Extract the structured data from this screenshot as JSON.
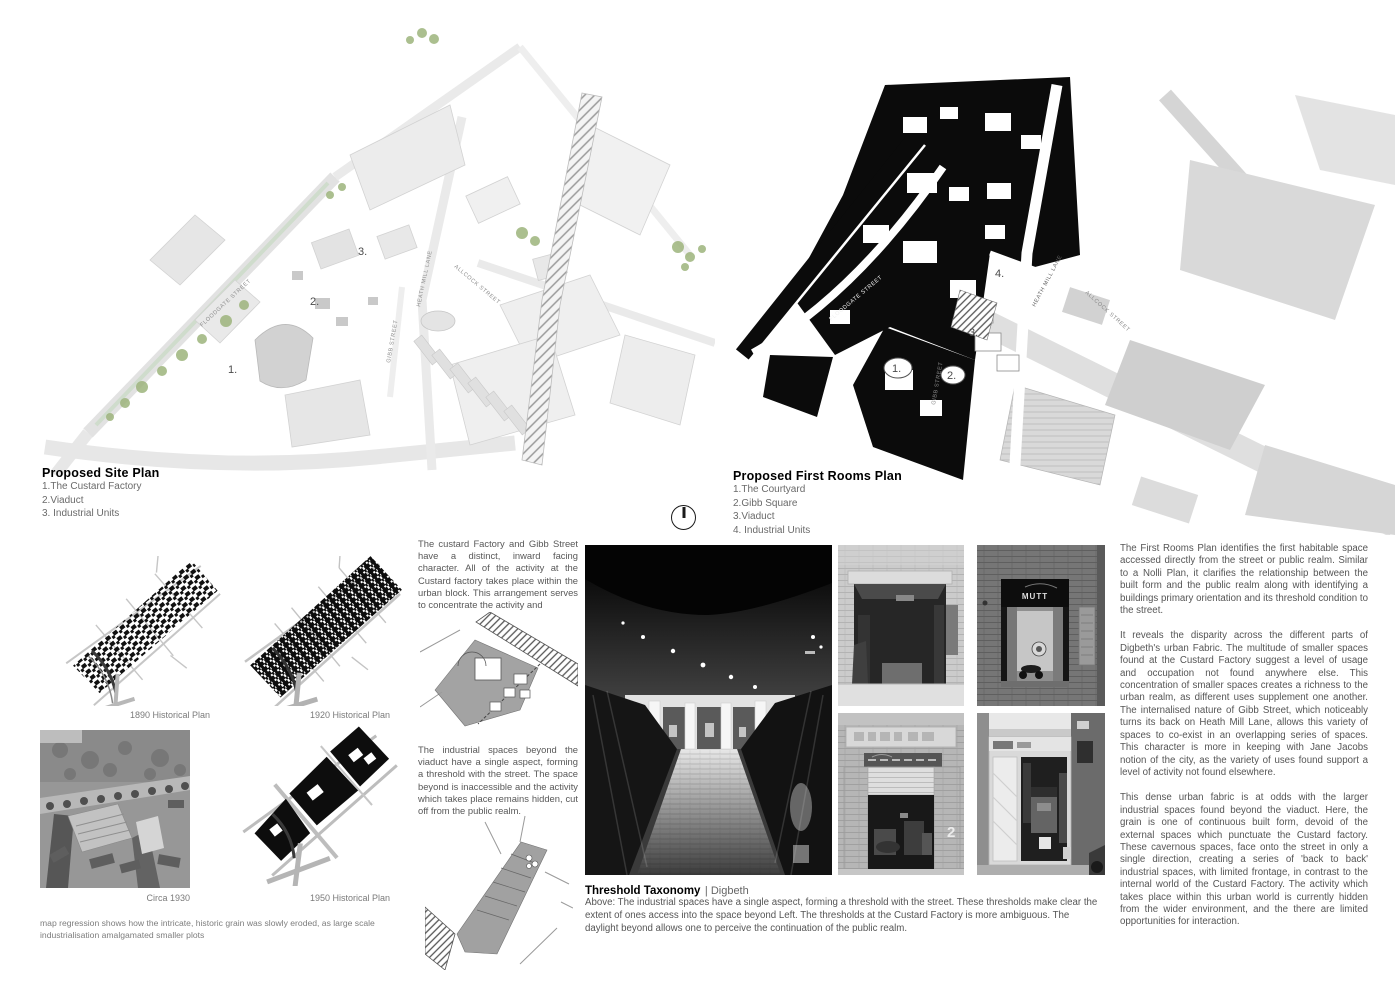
{
  "site_plan": {
    "title": "Proposed Site Plan",
    "legend": [
      "1.The Custard Factory",
      "2.Viaduct",
      "3. Industrial Units"
    ],
    "streets": {
      "floodgate": "FLOODGATE STREET",
      "heath_mill": "HEATH MILL LANE",
      "allcock": "ALLCOCK STREET",
      "gibb": "GIBB STREET"
    },
    "markers": [
      "1.",
      "2.",
      "3."
    ]
  },
  "first_rooms_plan": {
    "title": "Proposed First Rooms Plan",
    "legend": [
      "1.The Courtyard",
      "2.Gibb Square",
      "3.Viaduct",
      "4. Industrial Units"
    ],
    "streets": {
      "floodgate": "FLOODGATE STREET",
      "heath_mill": "HEATH MILL LANE",
      "allcock": "ALLCOCK STREET",
      "gibb": "GIBB STREET"
    },
    "markers": [
      "1.",
      "2.",
      "3.",
      "4."
    ]
  },
  "historical": {
    "label_1890": "1890 Historical Plan",
    "label_1920": "1920 Historical Plan",
    "label_1930": "Circa 1930",
    "label_1950": "1950 Historical Plan",
    "caption": "map regression shows how the intricate, historic grain was slowly eroded, as large scale industrialisation amalgamated smaller plots"
  },
  "middle_column": {
    "para_custard": "The custard Factory and Gibb Street have a distinct, inward facing character. All of the activity at the Custard factory takes place within the urban block. This arrangement serves to concentrate the activity and",
    "para_industrial": "The industrial spaces beyond the viaduct have a single aspect, forming a threshold with the street. The space beyond is inaccessible and the activity which takes place remains hidden, cut off from the public realm."
  },
  "threshold": {
    "title": "Threshold Taxonomy",
    "location": "| Digbeth",
    "caption": "Above: The industrial spaces have a single aspect, forming a threshold with the street. These thresholds make clear the extent of ones access into the space beyond Left. The thresholds at the Custard Factory is more ambiguous. The daylight beyond allows one to perceive the continuation of the public realm."
  },
  "right_column": {
    "para_1": "The First Rooms Plan identifies the first habitable space accessed directly from the street or public realm. Similar to a Nolli Plan, it clarifies the relationship between the built form and the public realm along with identifying a buildings primary orientation and its threshold condition to the street.",
    "para_2": "It reveals the disparity across the different parts of Digbeth's urban Fabric. The multitude of smaller spaces found at the Custard Factory suggest a level of usage and occupation not found anywhere else. This concentration of smaller spaces creates a richness to the urban realm, as different uses supplement one another. The internalised nature of Gibb Street, which noticeably turns its back on Heath Mill Lane, allows this variety of spaces to co-exist in an overlapping series of spaces. This character is more in keeping with Jane Jacobs notion of the city, as the variety of uses found support a level of activity not found elsewhere.",
    "para_3": "This dense urban fabric is at odds with the larger industrial spaces found beyond the viaduct. Here, the grain is one of continuous built form, devoid of the external spaces which punctuate the Custard factory. These cavernous spaces, face onto the street in only a single direction, creating a series of 'back to back' industrial spaces, with limited frontage, in contrast to the internal world of the Custard Factory. The activity which takes place within this urban world is currently hidden from the wider environment, and the there are limited opportunities for interaction."
  },
  "photos": {
    "mutt_sign": "MUTT",
    "unit_number": "2"
  },
  "colors": {
    "tree_green": "#9db47c",
    "plan_black": "#0c0c0c",
    "map_gray": "#e6e6e6"
  }
}
